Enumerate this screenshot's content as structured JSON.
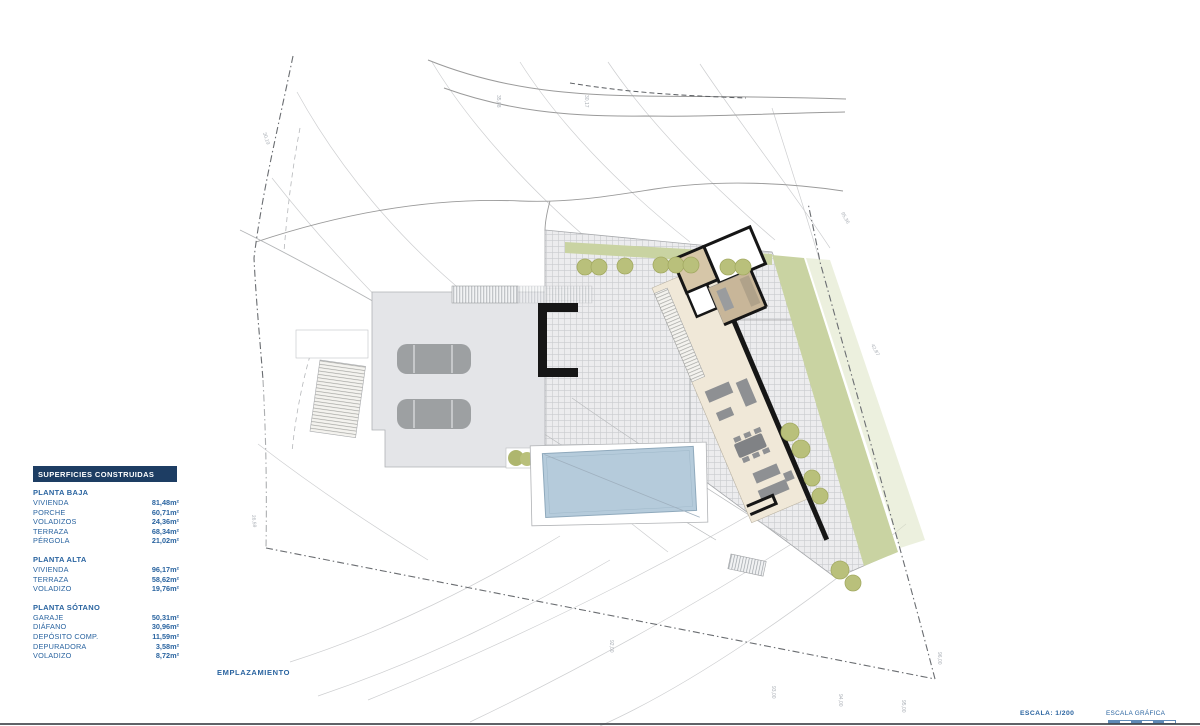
{
  "colors": {
    "navy": "#1d3d63",
    "blue": "#2a64a0",
    "pool_fill": "#b5cbdb",
    "pool_edge": "#8fa9bc",
    "green_band": "#c9d3a2",
    "green_band_light": "#dde3c3",
    "tree_fill": "#b9c07b",
    "tree_edge": "#a3aa62",
    "driveway": "#e4e5e8",
    "car": "#9da0a2",
    "house_floor": "#f0e8d8",
    "house_tile": "#c8b699",
    "wall_black": "#161616",
    "contour": "#cdced0",
    "boundary": "#6a6d71"
  },
  "surfaces_panel": {
    "header": "SUPERFICIES CONSTRUIDAS",
    "sections": [
      {
        "title": "PLANTA BAJA",
        "rows": [
          {
            "label": "VIVIENDA",
            "value": "81,48m²"
          },
          {
            "label": "PORCHE",
            "value": "60,71m²"
          },
          {
            "label": "VOLADIZOS",
            "value": "24,36m²"
          },
          {
            "label": "TERRAZA",
            "value": "68,34m²"
          },
          {
            "label": "PÉRGOLA",
            "value": "21,02m²"
          }
        ]
      },
      {
        "title": "PLANTA ALTA",
        "rows": [
          {
            "label": "VIVIENDA",
            "value": "96,17m²"
          },
          {
            "label": "TERRAZA",
            "value": "58,62m²"
          },
          {
            "label": "VOLADIZO",
            "value": "19,76m²"
          }
        ]
      },
      {
        "title": "PLANTA SÓTANO",
        "rows": [
          {
            "label": "GARAJE",
            "value": "50,31m²"
          },
          {
            "label": "DIÁFANO",
            "value": "30,96m²"
          },
          {
            "label": "DEPÓSITO COMP.",
            "value": "11,59m²"
          },
          {
            "label": "DEPURADORA",
            "value": "3,58m²"
          },
          {
            "label": "VOLADIZO",
            "value": "8,72m²"
          }
        ]
      }
    ]
  },
  "plan": {
    "title": "EMPLAZAMIENTO",
    "scale_label": "ESCALA:  1/200",
    "graphic_scale_label": "ESCALA GRÁFICA",
    "micro_labels": [
      {
        "text": "30,19",
        "x": 263,
        "y": 133,
        "angle": 72
      },
      {
        "text": "26,59",
        "x": 252,
        "y": 515,
        "angle": 85
      },
      {
        "text": "35,08",
        "x": 497,
        "y": 95,
        "angle": 90
      },
      {
        "text": "30,17",
        "x": 585,
        "y": 95,
        "angle": 90
      },
      {
        "text": "95,36",
        "x": 841,
        "y": 213,
        "angle": 62
      },
      {
        "text": "42,87",
        "x": 871,
        "y": 345,
        "angle": 62
      },
      {
        "text": "92,00",
        "x": 610,
        "y": 640,
        "angle": 90
      },
      {
        "text": "93,00",
        "x": 772,
        "y": 686,
        "angle": 90
      },
      {
        "text": "94,00",
        "x": 839,
        "y": 694,
        "angle": 90
      },
      {
        "text": "95,00",
        "x": 902,
        "y": 700,
        "angle": 90
      },
      {
        "text": "96,00",
        "x": 938,
        "y": 652,
        "angle": 90
      }
    ]
  }
}
